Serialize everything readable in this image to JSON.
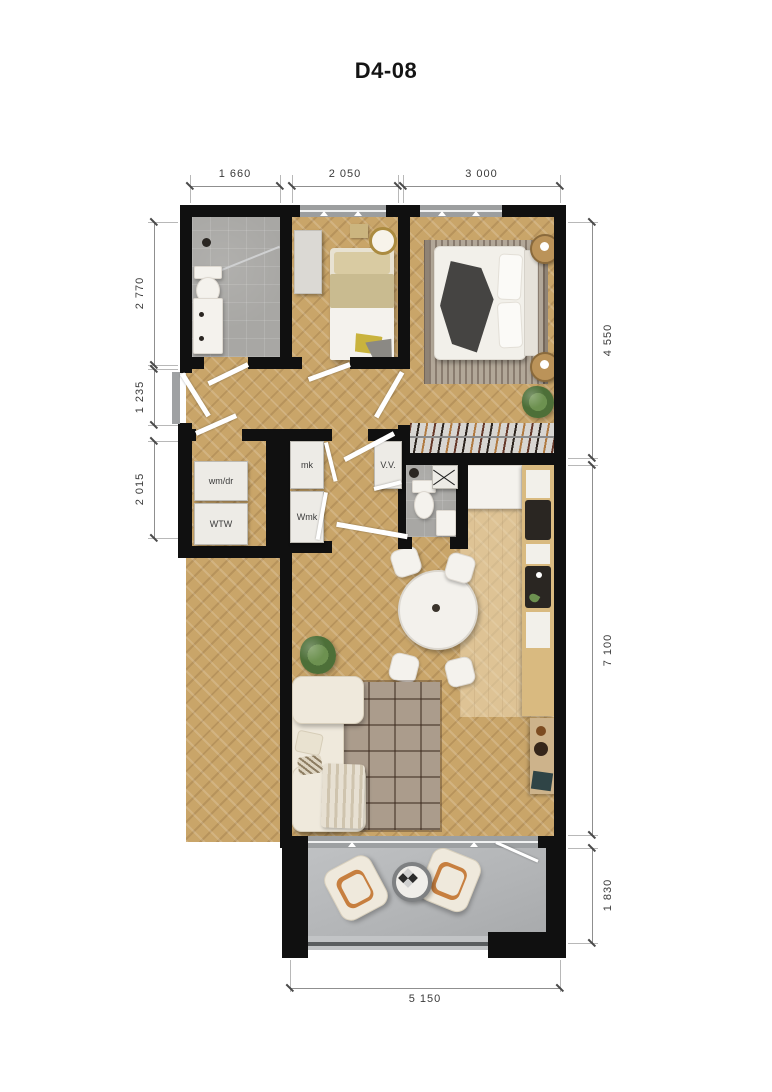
{
  "title": "D4-08",
  "dimensions": {
    "top": [
      "1 660",
      "2 050",
      "3 000"
    ],
    "left": [
      "2 770",
      "1 235",
      "2 015"
    ],
    "right": [
      "4 550",
      "7 100",
      "1 830"
    ],
    "bottom": [
      "5 150"
    ]
  },
  "labels": {
    "washer_dryer": "wm/dr",
    "heat_recovery_unit": "WTW",
    "meter_cupboard": "mk",
    "water_meter_cupboard": "Wmk",
    "ventilation_unit": "V.V."
  },
  "colors": {
    "wall": "#101010",
    "wood_floor": "#c9a569",
    "tile_floor": "#a8a7a4",
    "balcony_floor": "#b2b4b6",
    "window_frame": "#9c9e9f",
    "counter_wood": "#d9ba80",
    "furniture_cream": "#efe9dc",
    "accent_dark": "#2a2622",
    "dimension_line": "#8f8f8f",
    "dimension_text": "#3a3a3a"
  }
}
